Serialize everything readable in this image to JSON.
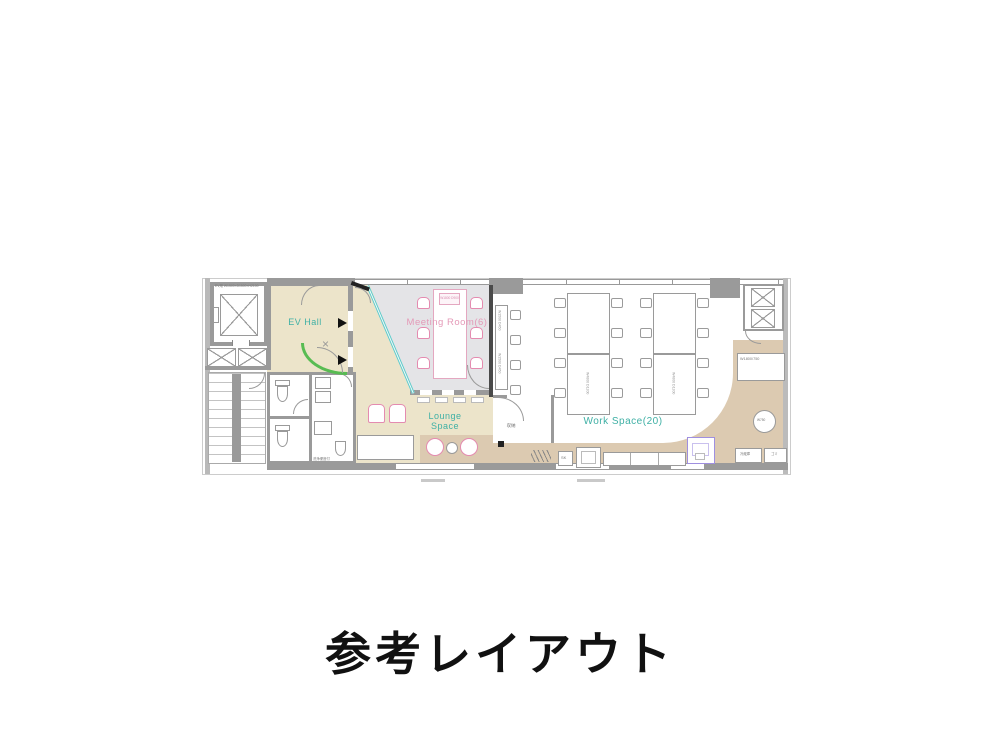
{
  "title": "参考レイアウト",
  "plan": {
    "rooms": {
      "ev_hall": "EV Hall",
      "meeting": "Meeting Room(6)",
      "lounge": "Lounge Space",
      "work": "Work Space(20)",
      "storage": "収納"
    },
    "labels": {
      "elevator_spec": "EV用 W1500×D1500×H2100",
      "meeting_table": "W1800 D900",
      "work_counter": "W1500 D450",
      "work_desk": "W4800 D1200",
      "chair_pitch": "W750",
      "side_counter": "W1800/750",
      "round_table": "W750",
      "sink": "SK",
      "fridge": "冷蔵庫",
      "trash": "ゴミ",
      "wc_note": "洗浄便座付"
    },
    "colors": {
      "accent_teal": "#3fb0a5",
      "accent_pink": "#e48bb0",
      "floor_tan": "#ece4ca",
      "floor_gray": "#e4e4e7",
      "floor_wood": "#dccab1",
      "wall_gray": "#9a9a9a",
      "glass_teal": "#5fc9c9",
      "accent_green": "#58bc52",
      "booth_purple": "#9f8fe0"
    }
  }
}
